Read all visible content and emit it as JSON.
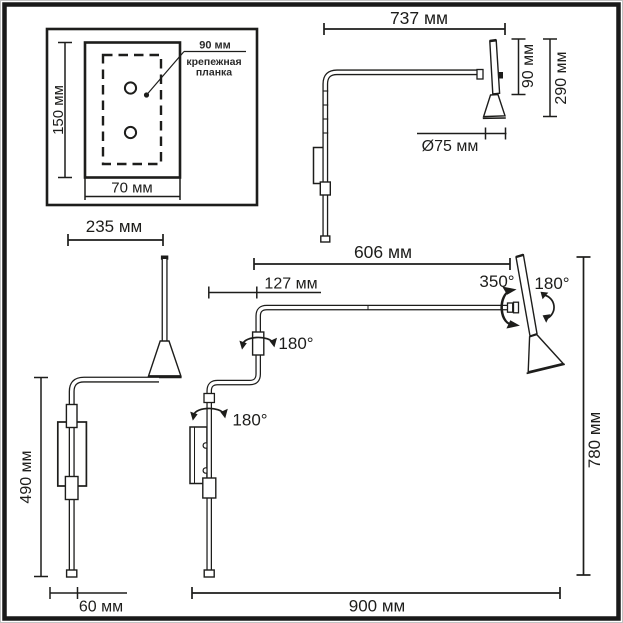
{
  "diagram": {
    "inset": {
      "height": "150 мм",
      "width": "70 мм",
      "plate_width": "90 мм",
      "plate_label_line1": "крепежная",
      "plate_label_line2": "планка"
    },
    "side_view": {
      "arm_length": "737 мм",
      "stem_height": "90 мм",
      "head_drop": "290 мм",
      "shade_diameter": "Ø75 мм"
    },
    "folded_view": {
      "depth": "235 мм",
      "body_height": "490 мм",
      "base_width": "60 мм"
    },
    "extended_view": {
      "arm_reach": "606 мм",
      "wall_offset": "127 мм",
      "head_swivel": "350°",
      "head_tilt": "180°",
      "elbow_swivel": "180°",
      "base_swivel": "180°",
      "total_height": "780 мм",
      "total_reach": "900 мм"
    }
  },
  "colors": {
    "line": "#1d1d1b",
    "background": "#ffffff"
  }
}
